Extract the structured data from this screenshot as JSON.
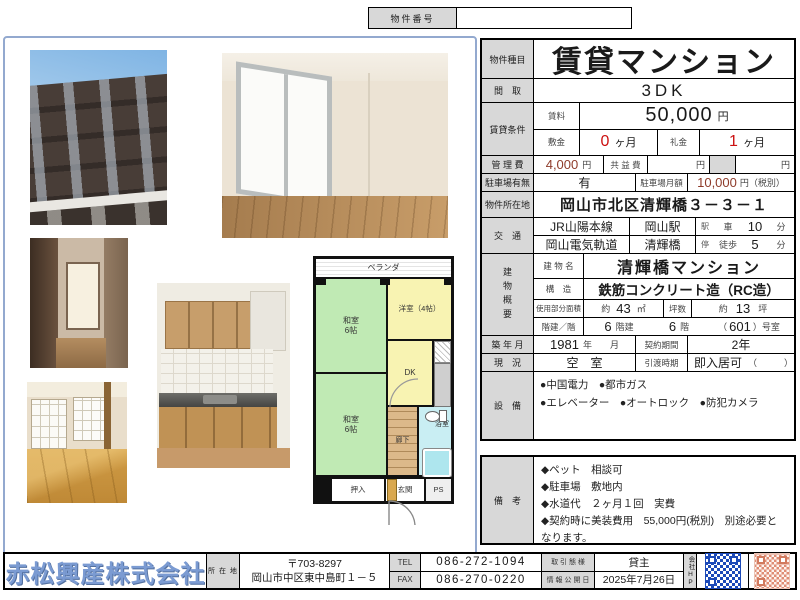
{
  "property_number": {
    "label": "物件番号",
    "value": ""
  },
  "table": {
    "type_label": "物件種目",
    "type_value": "賃貸マンション",
    "madori_label": "間　取",
    "madori_value": "3DK",
    "cond_label": "賃貸条件",
    "rent_label": "賃料",
    "rent_value": "50,000",
    "rent_unit": "円",
    "shikikin_label": "敷金",
    "shikikin_value": "0",
    "shikikin_unit": "ヶ月",
    "reikin_label": "礼金",
    "reikin_value": "1",
    "reikin_unit": "ヶ月",
    "kanrihi_label": "管 理 費",
    "kanrihi_value": "4,000",
    "kanrihi_unit": "円",
    "kyoekihi_label": "共 益 費",
    "kyoekihi_unit": "円",
    "kyoekihi_unit2": "円",
    "parking_label": "駐車場有無",
    "parking_value": "有",
    "parking_fee_label": "駐車場月額",
    "parking_fee_value": "10,000",
    "parking_fee_unit": "円（税別）",
    "address_label": "物件所在地",
    "address_value": "岡山市北区清輝橋３－３－１",
    "kotsu_label": "交　通",
    "transit": [
      {
        "line": "JR山陽本線",
        "station": "岡山駅",
        "stop": "駅",
        "mode": "車",
        "min": "10",
        "unit": "分"
      },
      {
        "line": "岡山電気軌道",
        "station": "清輝橋",
        "stop": "停",
        "mode": "徒歩",
        "min": "5",
        "unit": "分"
      }
    ],
    "gaiyo_label": "建物概要",
    "bname_label": "建 物 名",
    "bname_value": "清輝橋マンション",
    "kozo_label": "構　造",
    "kozo_value": "鉄筋コンクリート造（RC造）",
    "menseki_label": "使用部分面積",
    "menseki_prefix": "約",
    "menseki_num": "43",
    "menseki_unit": "㎡",
    "tsubo_label": "坪数",
    "tsubo_prefix": "約",
    "tsubo_num": "13",
    "tsubo_unit": "坪",
    "kaidate_label": "階建／階",
    "kaidate_num": "6",
    "kaidate_suffix": "階建",
    "kai_num": "6",
    "kai_suffix": "階",
    "room_prefix": "（",
    "room_num": "601",
    "room_suffix": "）号室",
    "chiku_label": "築 年 月",
    "chiku_value": "1981",
    "chiku_unit": "年",
    "chiku_month": "月",
    "keiyaku_label": "契約期間",
    "keiyaku_value": "2年",
    "genkyo_label": "現　況",
    "genkyo_value": "空　室",
    "hikiwatashi_label": "引渡時期",
    "hikiwatashi_value": "即入居可",
    "hikiwatashi_paren": "（　　　）",
    "setsubi_label": "設　備",
    "setsubi_lines": [
      "●中国電力　●都市ガス",
      "●エレベーター　●オートロック　●防犯カメラ"
    ]
  },
  "remarks": {
    "label": "備　考",
    "items": [
      "◆ペット　相談可",
      "◆駐車場　敷地内",
      "◆水道代　２ヶ月１回　実費",
      "◆契約時に美装費用　55,000円(税別)　別途必要となります。"
    ]
  },
  "floorplan": {
    "veranda": "ベランダ",
    "washitsu_top": "和室\n6帖",
    "youshitsu": "洋室（4帖）",
    "dk": "DK",
    "washitsu_bottom": "和室\n6帖",
    "rouka": "廊下",
    "bath": "浴室",
    "oshiire": "押入",
    "genkan": "玄関",
    "ps": "PS"
  },
  "footer": {
    "company": "赤松興産株式会社",
    "location_label": "所 在 地",
    "postal": "〒703-8297",
    "address": "岡山市中区東中島町１－５",
    "tel_label": "TEL",
    "tel_value": "086-272-1094",
    "fax_label": "FAX",
    "fax_value": "086-270-0220",
    "deal_label": "取 引 態 様",
    "deal_value": "貸主",
    "date_label": "情 報 公 開 日",
    "date_value": "2025年7月26日",
    "hp_label": "会社HP"
  },
  "colors": {
    "accent_red": "#cc1111",
    "number_maroon": "#8e3b2a",
    "company_blue": "#7b9bd2",
    "label_gray": "#d8d8d8",
    "plan_green": "#c0eab4",
    "plan_yellow": "#f8f3b2",
    "plan_cyan": "#c9eef3",
    "plan_wood": "#dcb98a",
    "frame_blue": "#93a9cf"
  }
}
